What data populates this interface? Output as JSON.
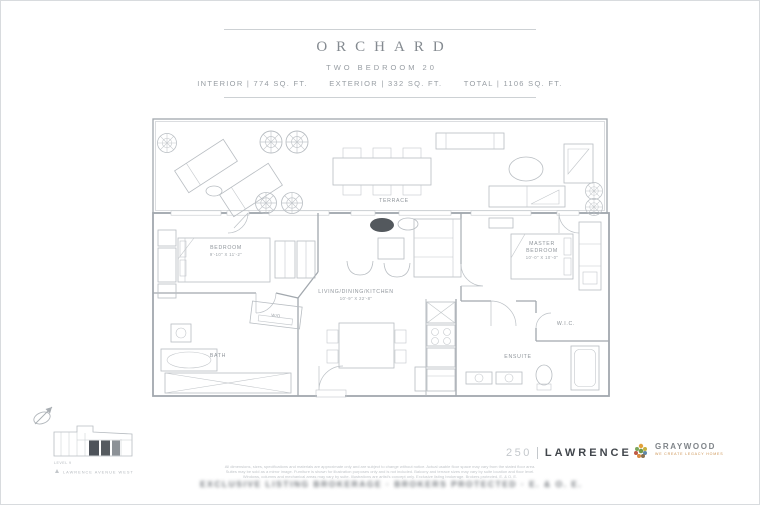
{
  "header": {
    "title": "ORCHARD",
    "subtitle": "TWO BEDROOM 20",
    "stats": [
      "INTERIOR | 774 SQ. FT.",
      "EXTERIOR | 332 SQ. FT.",
      "TOTAL | 1106 SQ. FT."
    ]
  },
  "floorplan": {
    "terrace_label": "TERRACE",
    "bedroom_label": "BEDROOM",
    "bedroom_dim": "9'-10\" X 11'-2\"",
    "living_label": "LIVING/DINING/KITCHEN",
    "living_dim": "10'-9\" X 22'-8\"",
    "master_label1": "MASTER",
    "master_label2": "BEDROOM",
    "master_dim": "10'-0\" X 10'-0\"",
    "bath_label": "BATH",
    "laundry_label": "W/D",
    "ensuite_label": "ENSUITE",
    "wic_label": "W.I.C."
  },
  "keyplan": {
    "caption": "LEVEL 9",
    "street": "LAWRENCE AVENUE WEST"
  },
  "branding": {
    "project_number": "250",
    "project_name": "LAWRENCE",
    "developer": "GRAYWOOD",
    "developer_tagline": "WE CREATE LEGACY HOMES",
    "logo_colors": [
      "#e2a23c",
      "#7aa65c",
      "#c8b23e",
      "#bf5a45",
      "#6f9a4e",
      "#5f87a8",
      "#d98a3f",
      "#8a6f4e"
    ]
  },
  "footer": {
    "disclaimer_lines": [
      "All dimensions, sizes, specifications and materials are approximate only and are subject to change without notice. Actual usable floor space may vary from the stated floor area.",
      "Suites may be sold as a mirror image. Furniture is shown for illustration purposes only and is not included. Balcony and terrace sizes may vary by suite location and floor level.",
      "Windows, columns and mechanical areas may vary by suite. Illustrations are artist's concept only. Exclusive listing brokerage. Brokers protected. E. & O. E."
    ],
    "blurred_text": "EXCLUSIVE LISTING BROKERAGE · BROKERS PROTECTED · E. & O. E."
  }
}
